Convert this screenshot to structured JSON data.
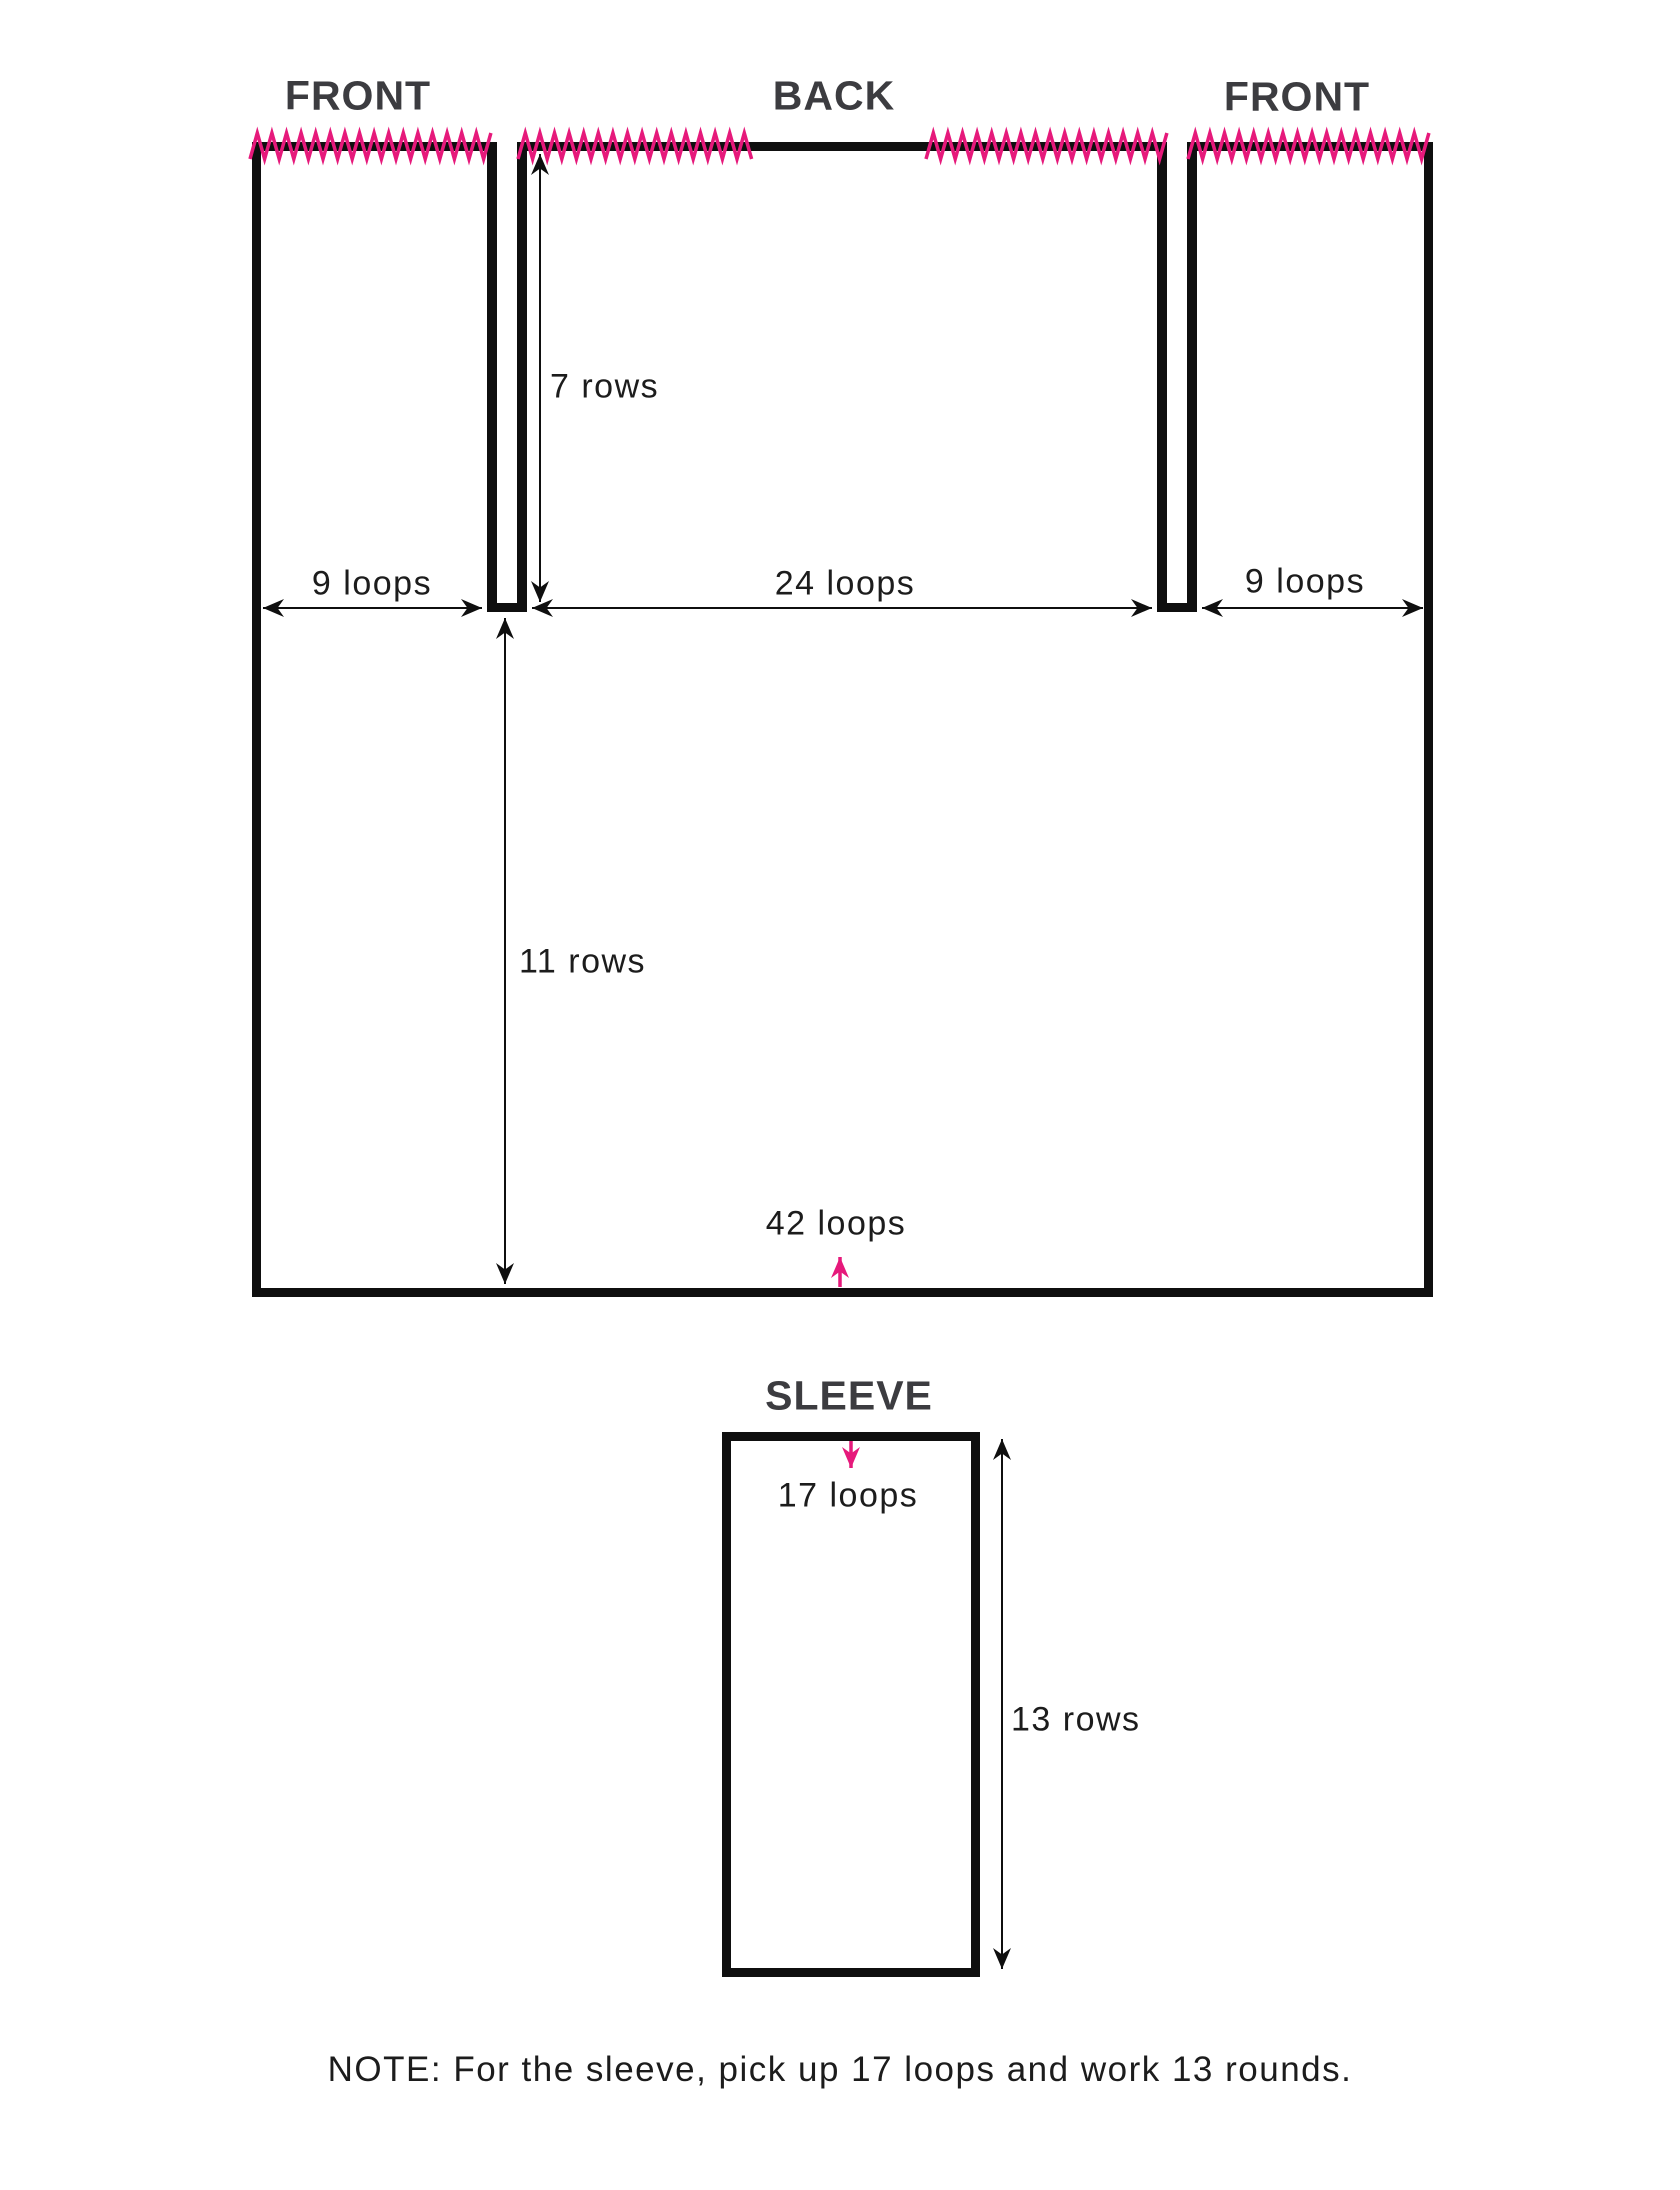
{
  "colors": {
    "accent_pink": "#e6197b",
    "title_gray": "#3c3c40",
    "line_black": "#0f0f0f"
  },
  "titles": {
    "front_left": "FRONT",
    "back": "BACK",
    "front_right": "FRONT",
    "sleeve": "SLEEVE"
  },
  "labels": {
    "front_left_width": "9 loops",
    "back_width": "24 loops",
    "front_right_width": "9 loops",
    "yoke_height": "7 rows",
    "body_height": "11 rows",
    "body_width": "42 loops",
    "sleeve_width": "17 loops",
    "sleeve_height": "13 rows"
  },
  "note": "NOTE: For the sleeve, pick up 17 loops and work 13 rounds."
}
